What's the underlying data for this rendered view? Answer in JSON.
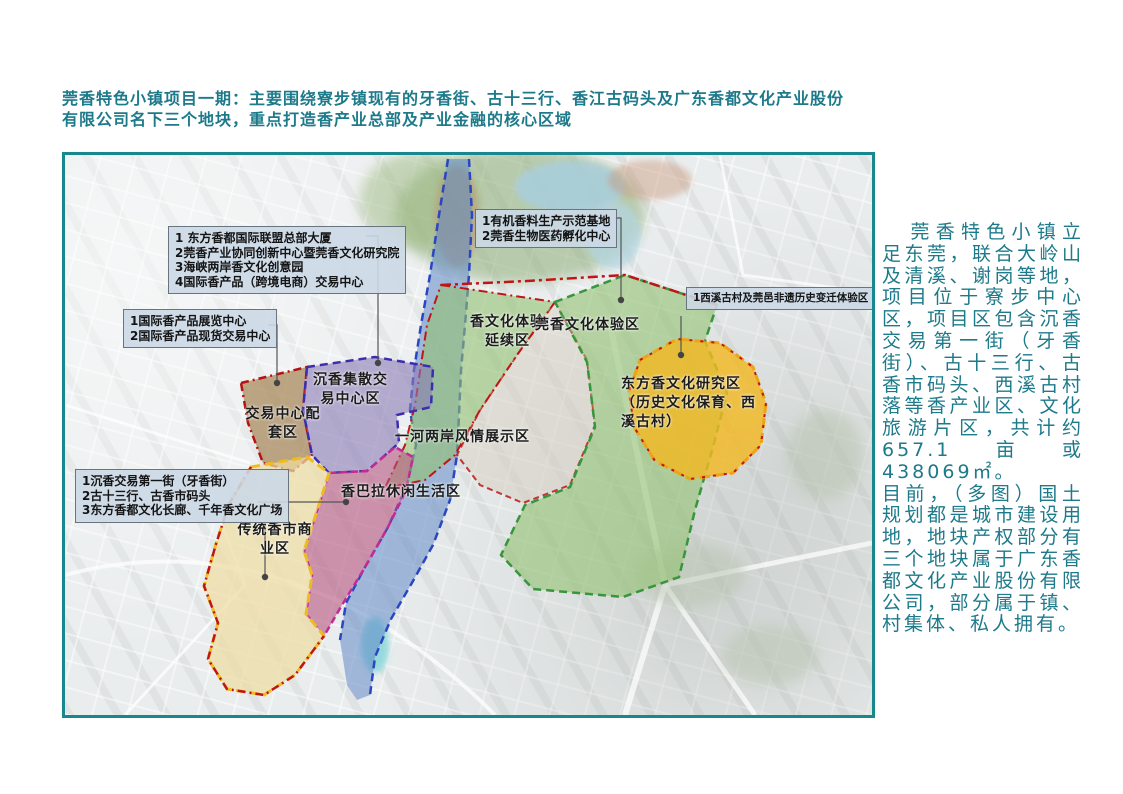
{
  "title": {
    "text": "莞香特色小镇项目一期：主要围绕寮步镇现有的牙香街、古十三行、香江古码头及广东香都文化产业股份有限公司名下三个地块，重点打造香产业总部及产业金融的核心区域"
  },
  "sidebar": {
    "paragraph1": "莞香特色小镇立足东莞，联合大岭山及清溪、谢岗等地，项目位于寮步中心区，项目区包含沉香交易第一街（牙香街）、古十三行、古香市码头、西溪古村落等香产业区、文化旅游片区，共计约657.1亩或438069㎡。",
    "paragraph2": "目前，（多图）国土规划都是城市建设用地，地块产权部分有三个地块属于广东香都文化产业股份有限公司，部分属于镇、村集体、私人拥有。"
  },
  "map": {
    "callouts": {
      "hq": {
        "lines": [
          "1 东方香都国际联盟总部大厦",
          "2莞香产业协同创新中心暨莞香文化研究院",
          "3海峡两岸香文化创意园",
          "4国际香产品（跨境电商）交易中心"
        ]
      },
      "expo": {
        "lines": [
          "1国际香产品展览中心",
          "2国际香产品现货交易中心"
        ]
      },
      "bio": {
        "lines": [
          "1有机香料生产示范基地",
          "2莞香生物医药孵化中心"
        ]
      },
      "xixi": {
        "lines": [
          "1西溪古村及莞邑非遗历史变迁体验区"
        ]
      },
      "street": {
        "lines": [
          "1沉香交易第一街（牙香街）",
          "2古十三行、古香市码头",
          "3东方香都文化长廊、千年香文化广场"
        ]
      }
    },
    "zones": {
      "incense_extension": {
        "lines": [
          "香文化体验",
          "延续区"
        ]
      },
      "guanxiang_experience": {
        "lines": [
          "莞香文化体验区"
        ]
      },
      "oriental_research": {
        "lines": [
          "东方香文化研究区",
          "（历史文化保育、西",
          "溪古村）"
        ]
      },
      "chenxiang_trading": {
        "lines": [
          "沉香集散交",
          "易中心区"
        ]
      },
      "trading_support": {
        "lines": [
          "交易中心配",
          "套区"
        ]
      },
      "riverside_display": {
        "lines": [
          "一河两岸风情展示区"
        ]
      },
      "shangbala_living": {
        "lines": [
          "香巴拉休闲生活区"
        ]
      },
      "traditional_market": {
        "lines": [
          "传统香市商",
          "业区"
        ]
      }
    }
  },
  "colors": {
    "accent_teal_text": "#1d7a8a",
    "map_border_teal": "#16888e",
    "callout_bg": "#cbd8e5",
    "zone_purple": "#8b7cb5",
    "zone_brown": "#9c7a45",
    "zone_green": "#92c272",
    "zone_orange": "#f2b822",
    "zone_river_blue": "#6189c6",
    "zone_maroon": "#b5537d",
    "zone_pale_yellow": "#efdca2",
    "boundary_red": "#c01515",
    "boundary_blue": "#2a46c0",
    "boundary_magenta": "#c22a96"
  }
}
